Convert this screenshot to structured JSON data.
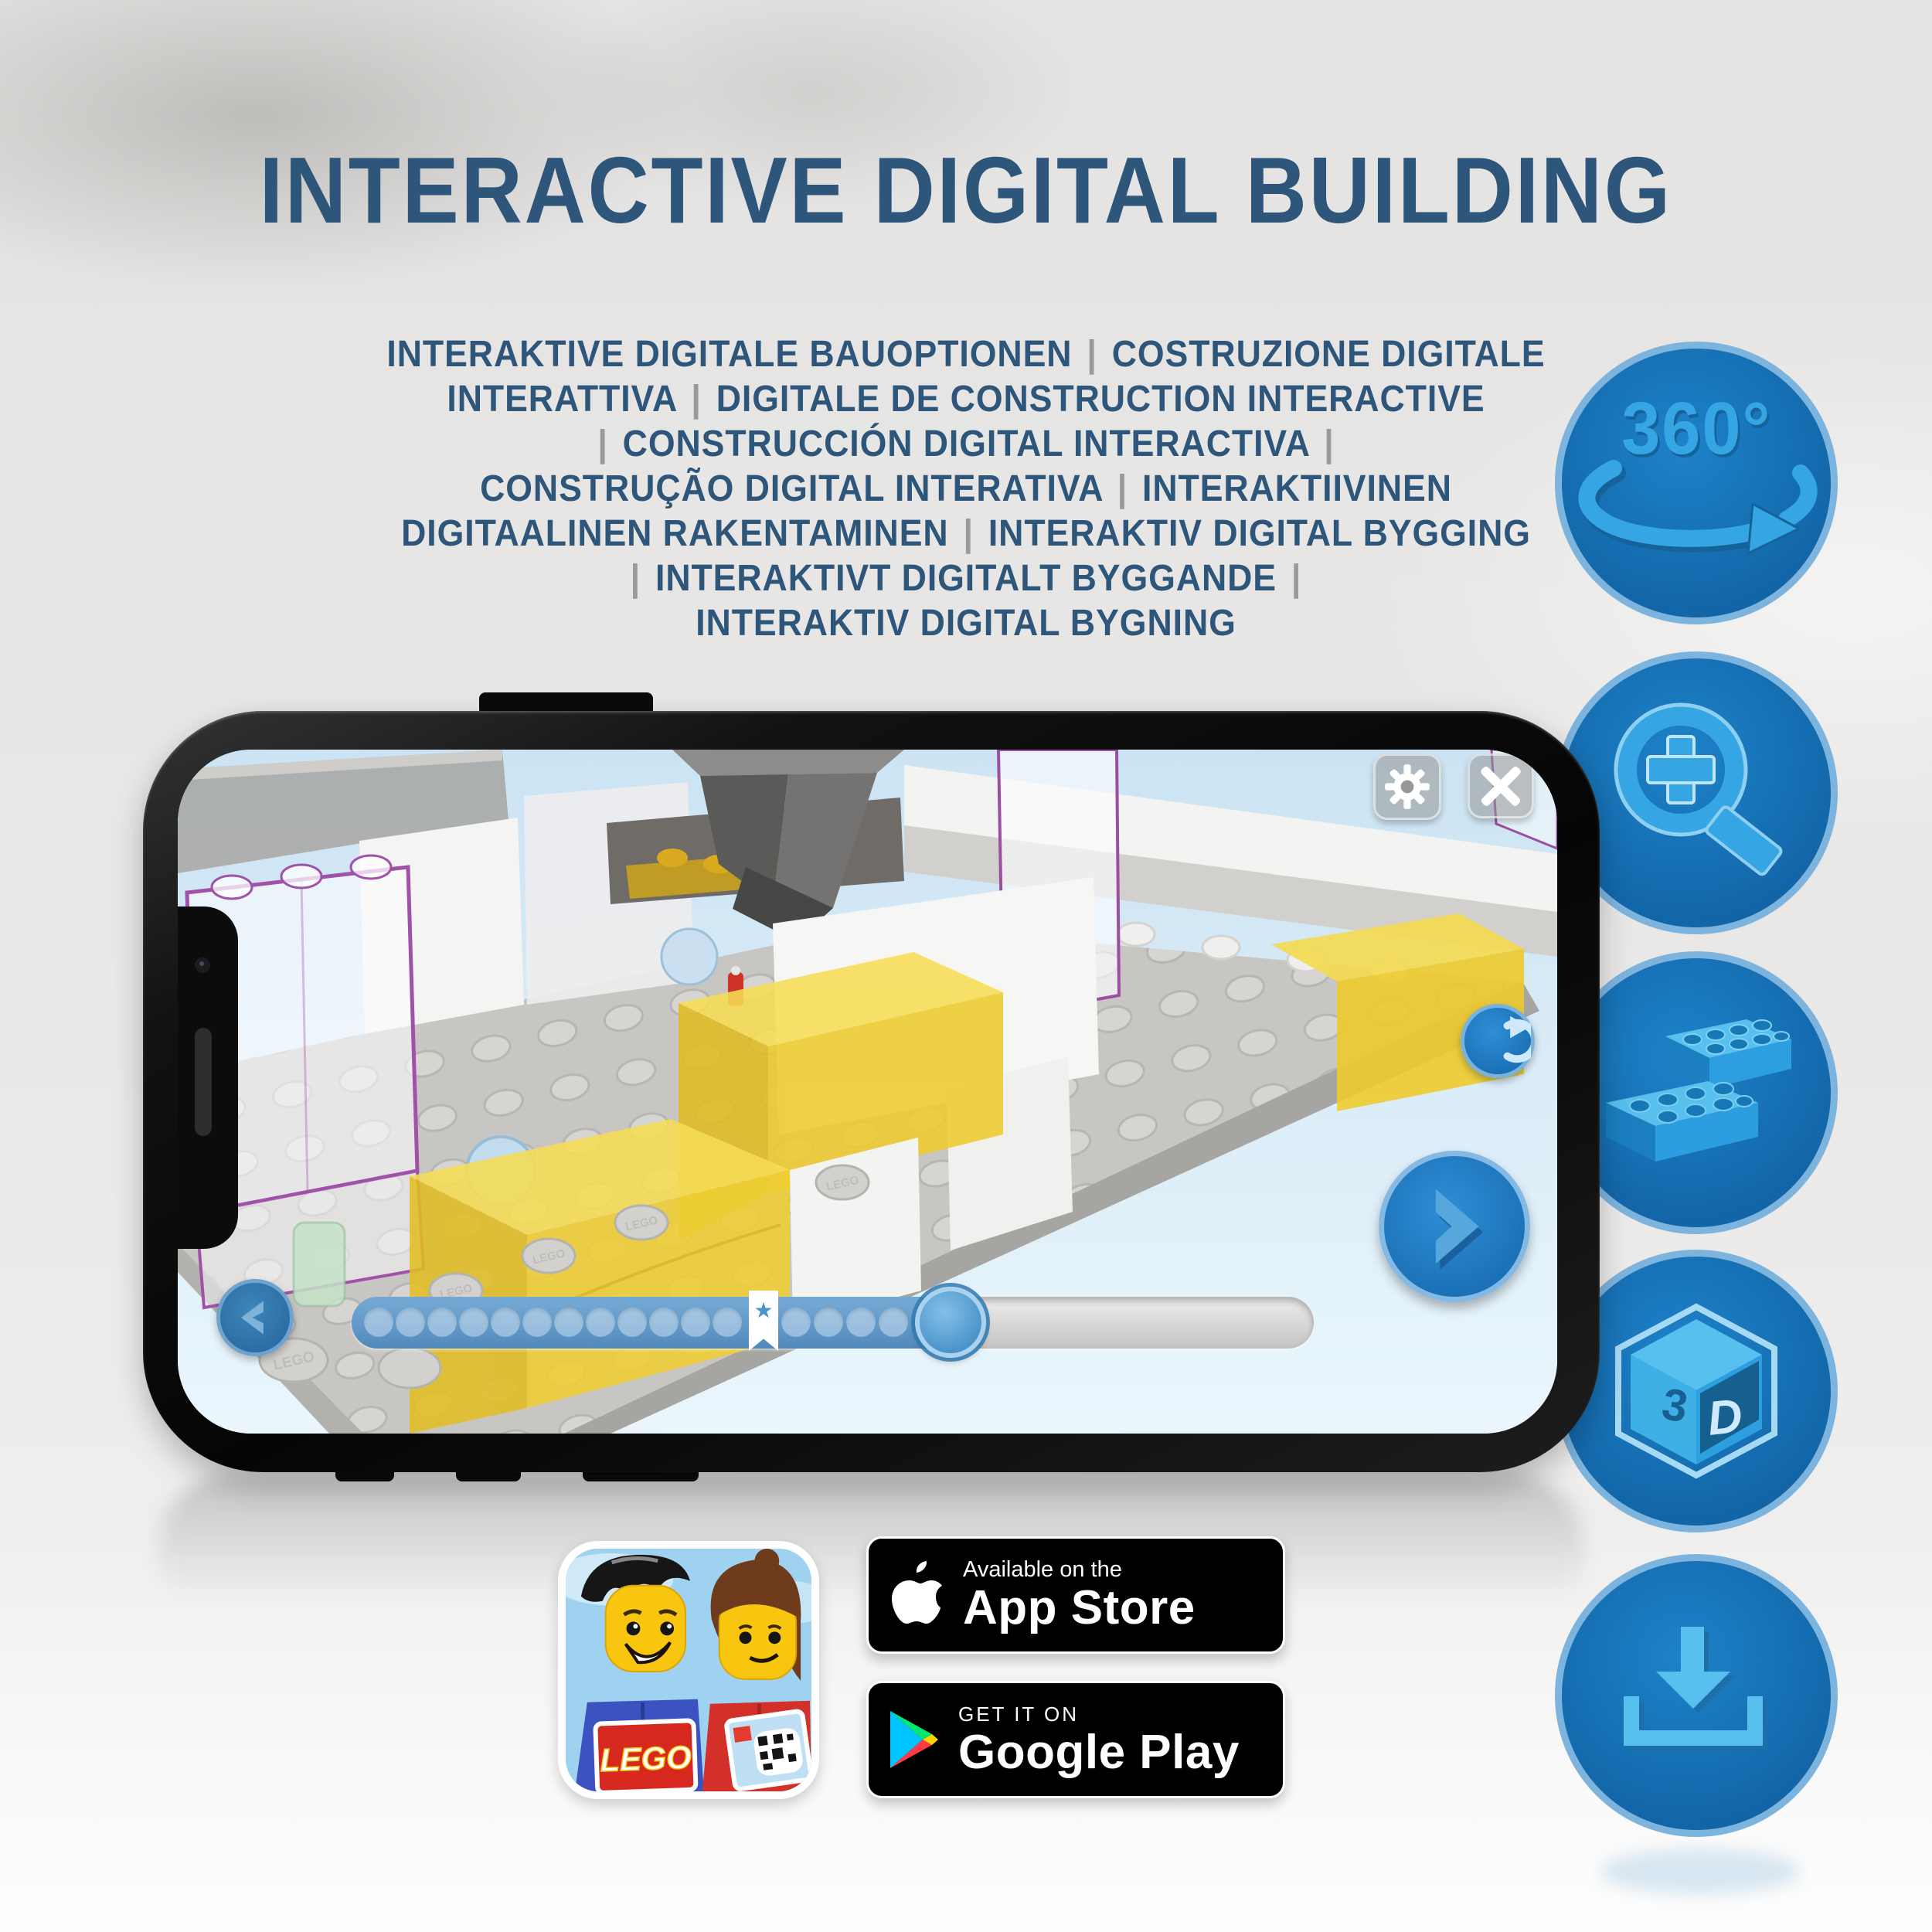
{
  "title": "INTERACTIVE DIGITAL BUILDING",
  "subtitle_lines": [
    "INTERAKTIVE DIGITALE BAUOPTIONEN | COSTRUZIONE DIGITALE",
    "INTERATTIVA | DIGITALE DE CONSTRUCTION INTERACTIVE",
    "| CONSTRUCCIÓN DIGITAL INTERACTIVA |",
    "CONSTRUÇÃO DIGITAL INTERATIVA | INTERAKTIIVINEN",
    "DIGITAALINEN RAKENTAMINEN | INTERAKTIV DIGITAL BYGGING",
    "| INTERAKTIVT DIGITALT BYGGANDE |",
    "INTERAKTIV DIGITAL BYGNING"
  ],
  "feature_icons": [
    {
      "id": "rotate-360",
      "label": "360°"
    },
    {
      "id": "zoom-in"
    },
    {
      "id": "bricks"
    },
    {
      "id": "cube-3d",
      "left_text": "3",
      "right_text": "D"
    },
    {
      "id": "download"
    }
  ],
  "phone_app": {
    "scene_stud_text": "LEGO",
    "icons": {
      "star_marker": "★"
    },
    "progress": {
      "dots_before_marker": 12,
      "dots_after_marker": 4,
      "fill_percent": 63
    }
  },
  "badges": {
    "app_store": {
      "line1": "Available on the",
      "line2": "App Store"
    },
    "google_play": {
      "line1": "GET IT ON",
      "line2": "Google Play"
    }
  },
  "app_icon": {
    "logo_text": "LEGO"
  },
  "colors": {
    "title_blue": "#2E567A",
    "separator_gray": "#9A9A9A",
    "circle_fill": "#1B75BB",
    "circle_border": "#7DB4DE",
    "icon_light_blue": "#36A5E3",
    "brick_yellow": "#EFCF33",
    "outline_purple": "#9B4FA0",
    "sky_blue": "#D9EBF7"
  }
}
